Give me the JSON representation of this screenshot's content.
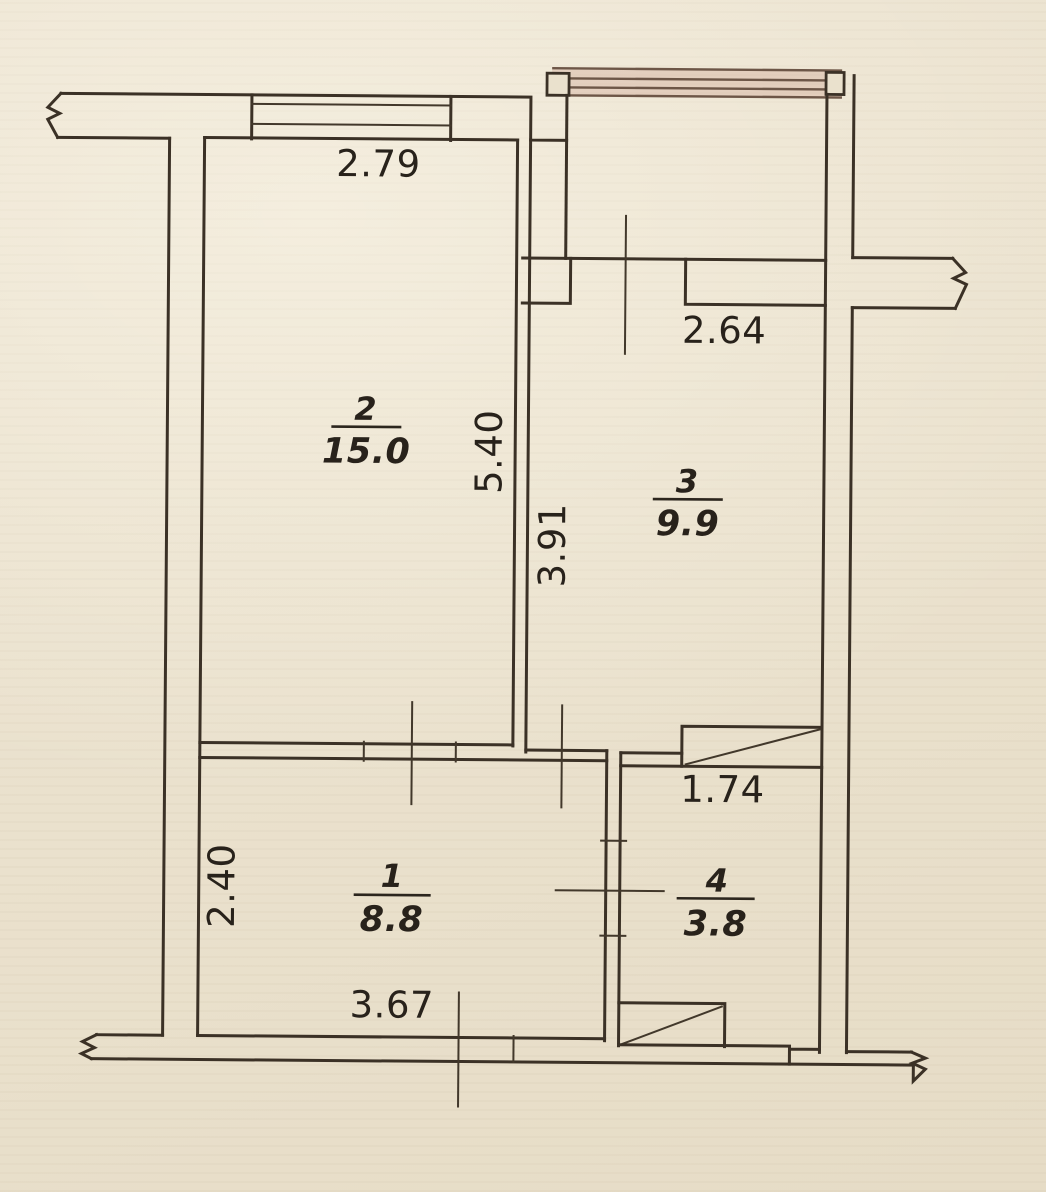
{
  "document": {
    "type": "scanned apartment floor plan (BTI style)",
    "units": "m"
  },
  "rooms": [
    {
      "number": "2",
      "area": "15.0"
    },
    {
      "number": "3",
      "area": "9.9"
    },
    {
      "number": "1",
      "area": "8.8"
    },
    {
      "number": "4",
      "area": "3.8"
    }
  ],
  "dims": {
    "room2_width": "2.79",
    "room2_depth": "5.40",
    "room3_width": "2.64",
    "room3_depth": "3.91",
    "room1_width": "3.67",
    "room1_depth": "2.40",
    "room4_width": "1.74"
  },
  "colors": {
    "paper": "#eae1cd",
    "ink": "#3b3126",
    "text": "#28221b",
    "balcony_glazing_tint": "#c89484"
  }
}
